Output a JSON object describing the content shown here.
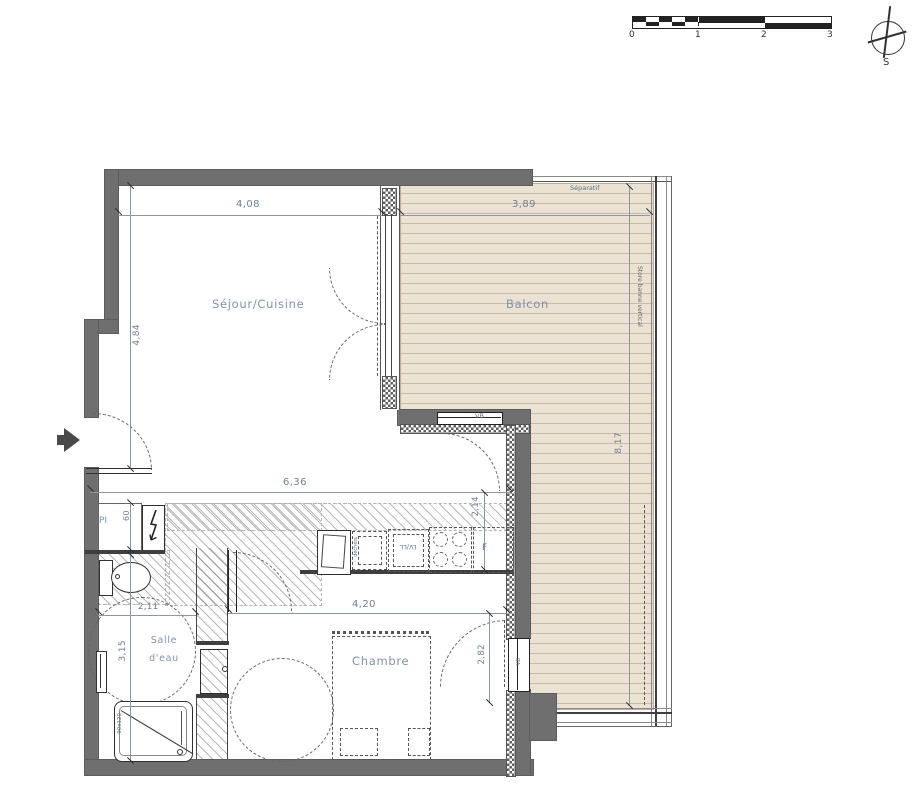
{
  "scale_bar": {
    "unit_labels": [
      "0",
      "1",
      "2",
      "3"
    ]
  },
  "compass": {
    "south": "S"
  },
  "rooms": {
    "sejour": {
      "label": "Séjour/Cuisine"
    },
    "balcon": {
      "label": "Balcon"
    },
    "chambre": {
      "label": "Chambre"
    },
    "salle_eau": {
      "label_line1": "Salle",
      "label_line2": "d'eau"
    }
  },
  "labels": {
    "separatif": "Séparatif",
    "store_banne": "Store banne vertical",
    "vb_top": "VB",
    "vb_right": "VB",
    "placard": "PI",
    "dechets": "déchets",
    "lv_ll": "LV/LL",
    "fridge": "F",
    "shower_size": "90x120"
  },
  "dimensions": {
    "sejour_width": "4,08",
    "balcon_width": "3,89",
    "sejour_height": "4,84",
    "hall_width": "6,36",
    "kitchen_depth": "2,14",
    "chambre_width": "4,20",
    "chambre_height": "2,82",
    "salle_width": "2,11",
    "salle_height": "3,15",
    "balcon_height": "8,17",
    "placard_width": "60"
  },
  "colors": {
    "wall": "#6f6f6f",
    "deck": "#ebe2d3",
    "deck_line": "#c9baa3",
    "room_label": "#7e93a9",
    "dimension_text": "#6e8092",
    "line": "#3f3f3f"
  }
}
